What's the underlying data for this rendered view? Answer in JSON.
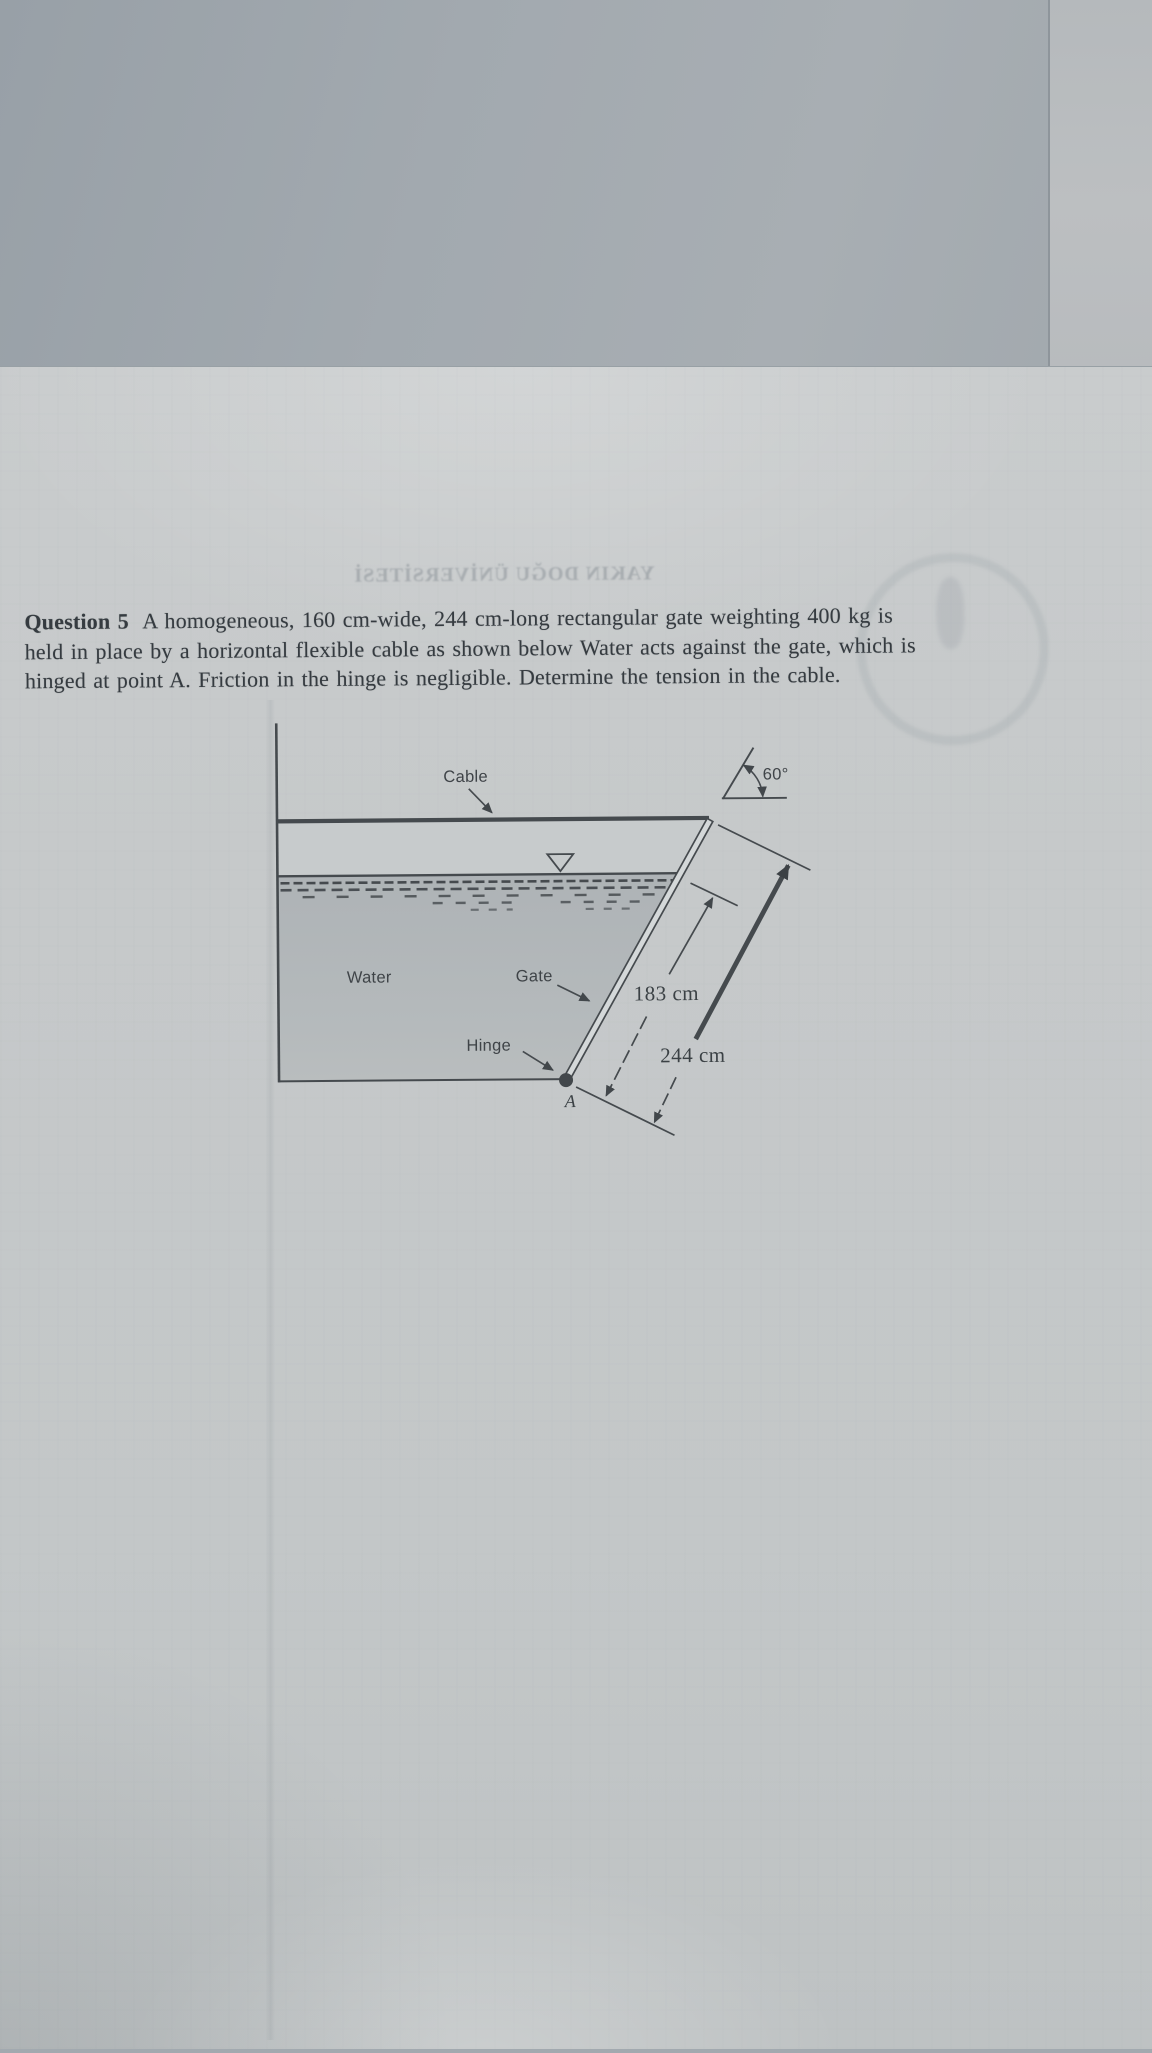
{
  "document": {
    "question": {
      "label": "Question 5",
      "full_text": "A homogeneous, 160 cm-wide, 244 cm-long rectangular gate weighting 400 kg is held in place by a horizontal flexible cable as shown below Water acts against the gate, which is hinged at point A. Friction in the hinge is negligible. Determine the tension in the cable.",
      "lines": [
        {
          "bold": "Question 5",
          "text": "  A homogeneous, 160 cm-wide, 244 cm-long rectangular gate weighting 400 kg is"
        },
        {
          "bold": "",
          "text": "held in place by a horizontal flexible cable as shown below Water acts against the gate, which is"
        },
        {
          "bold": "",
          "text": "hinged at point A. Friction in the hinge is negligible. Determine the tension in the cable."
        }
      ]
    },
    "bleed_through_text": "YAKIN DOĞU ÜNİVERSİTESİ"
  },
  "diagram": {
    "labels": {
      "cable": "Cable",
      "water": "Water",
      "gate": "Gate",
      "hinge": "Hinge",
      "point": "A",
      "angle": "60°",
      "dim_water_to_hinge": "183 cm",
      "dim_gate_length": "244 cm"
    },
    "values": {
      "angle_deg": 60,
      "water_to_hinge_cm": 183,
      "gate_length_cm": 244,
      "gate_width_cm": 160,
      "gate_mass_kg": 400
    }
  },
  "colors": {
    "background_top": "#a2a9af",
    "background_strip": "#b8bbbe",
    "paper": "#c5c9ca",
    "ink": "#353b40",
    "line": "#454a4e",
    "water_fill_top": "#aeb3b6",
    "water_fill_bottom": "#b9bdbe"
  }
}
